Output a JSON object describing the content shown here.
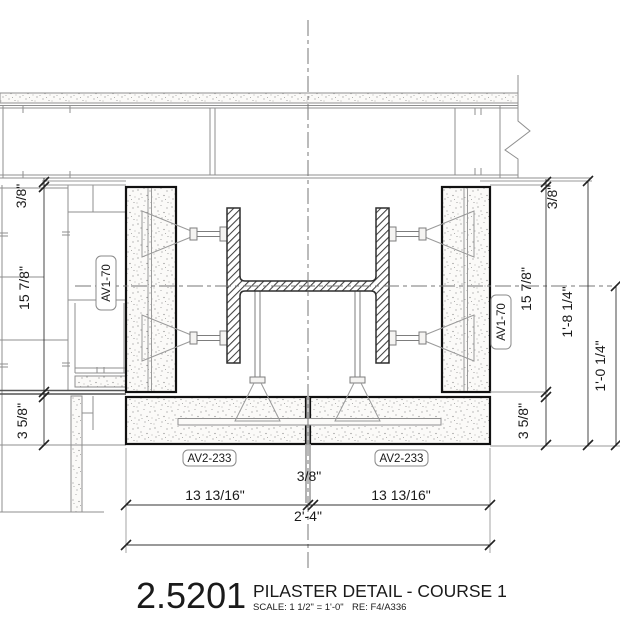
{
  "drawing": {
    "number": "2.5201",
    "title": "PILASTER DETAIL - COURSE 1",
    "scale": "SCALE:   1 1/2\" = 1'-0\"",
    "reference": "RE:  F4/A336"
  },
  "labels": {
    "pilaster_left": "AV1-70",
    "pilaster_right": "AV1-70",
    "course_left": "AV2-233",
    "course_right": "AV2-233"
  },
  "dimensions": {
    "left": {
      "top": "3/8\"",
      "middle": "15 7/8\"",
      "bottom": "3 5/8\""
    },
    "right": {
      "top": "3/8\"",
      "middle": "15 7/8\"",
      "bottom": "3 5/8\"",
      "overall_inner": "1'-8 1/4\"",
      "overall_outer": "1'-0 1/4\""
    },
    "bottom": {
      "left": "13 13/16\"",
      "joint": "3/8\"",
      "right": "13 13/16\"",
      "overall": "2'-4\""
    }
  },
  "colors": {
    "paper": "#ffffff",
    "ink": "#1a1a1a",
    "masonry_outline": "#111111",
    "existing": "#8f8f8f"
  }
}
